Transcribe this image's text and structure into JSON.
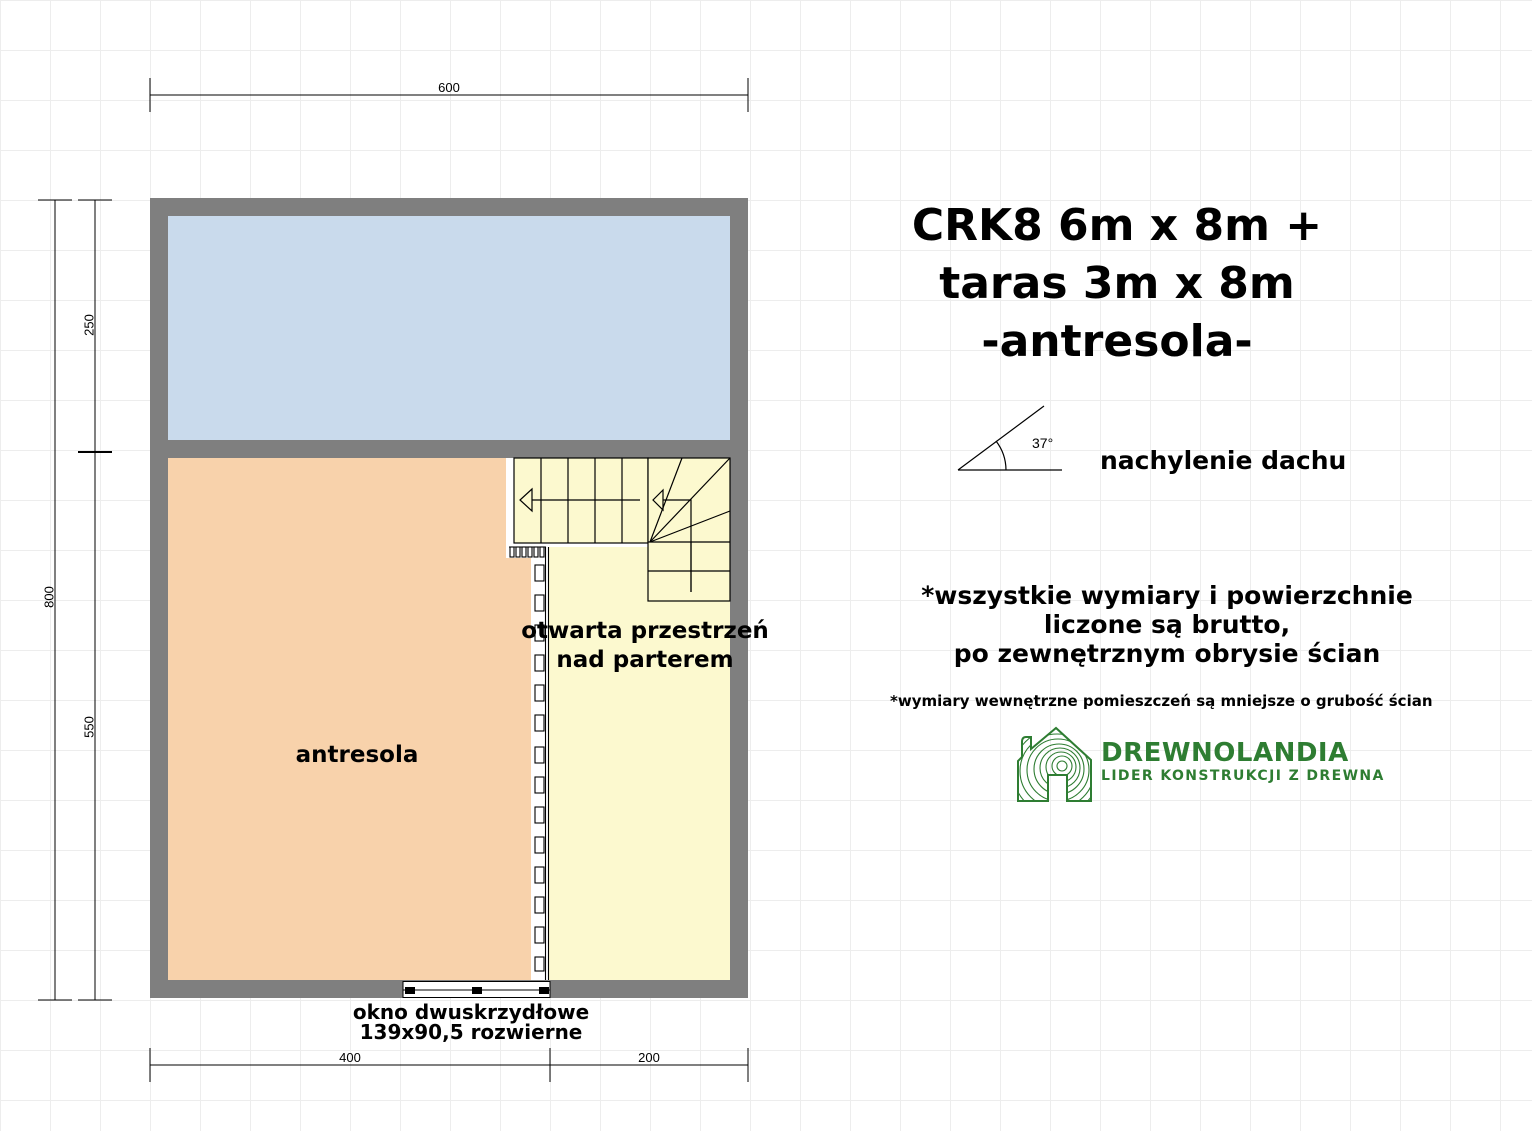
{
  "plan": {
    "rooms": {
      "antresola_label": "antresola",
      "open_space_line1": "otwarta przestrzeń",
      "open_space_line2": "nad parterem"
    },
    "window_label_line1": "okno dwuskrzydłowe",
    "window_label_line2": "139x90,5 rozwierne",
    "dimensions": {
      "top": "600",
      "left_total": "800",
      "left_upper": "250",
      "left_lower": "550",
      "bottom_left": "400",
      "bottom_right": "200"
    },
    "colors": {
      "wall": "#7f7f7f",
      "upper_room": "#c9daec",
      "antresola": "#f8d2ab",
      "open_space": "#fcf9cf"
    }
  },
  "info": {
    "title_line1": "CRK8 6m x 8m +",
    "title_line2": "taras 3m x 8m",
    "title_line3": "-antresola-",
    "roof": {
      "angle": "37°",
      "label": "nachylenie dachu"
    },
    "note_line1": "*wszystkie wymiary i powierzchnie",
    "note_line2": "liczone są brutto,",
    "note_line3": "po zewnętrznym obrysie ścian",
    "note_small": "*wymiary wewnętrzne pomieszczeń są mniejsze o grubość ścian",
    "logo": {
      "name": "DREWNOLANDIA",
      "tagline": "LIDER KONSTRUKCJI Z DREWNA",
      "color": "#2e7d32"
    }
  }
}
